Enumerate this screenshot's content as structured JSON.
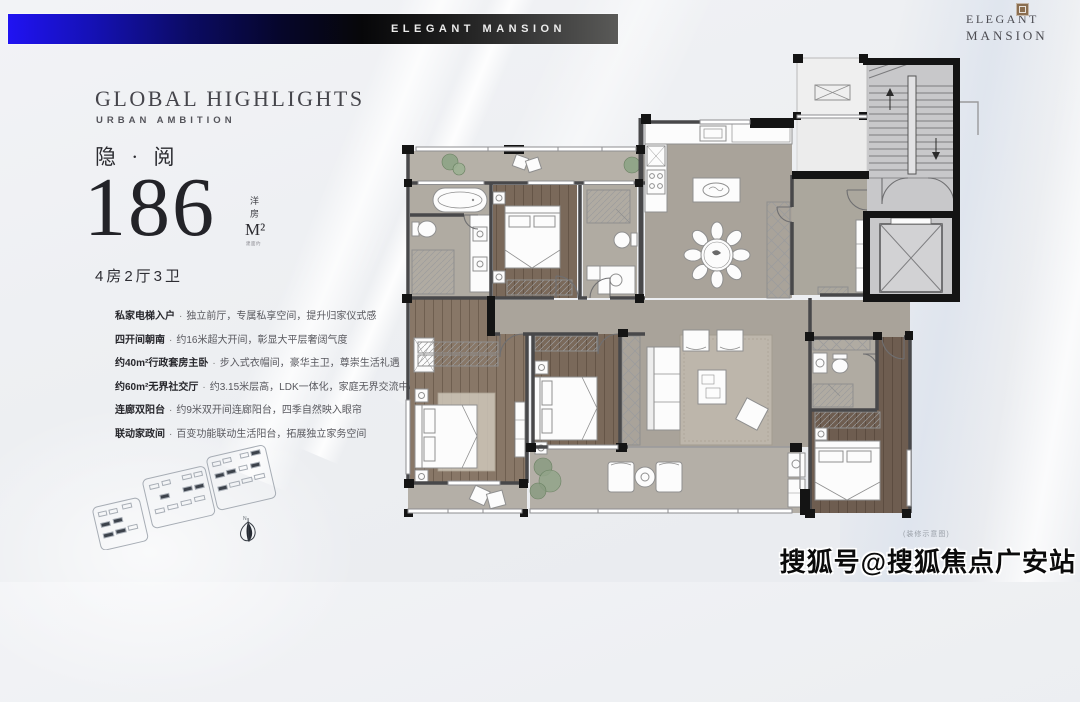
{
  "banner": {
    "title": "ELEGANT MANSION"
  },
  "logo": {
    "line1": "ELEGANT",
    "line2": "MANSION"
  },
  "panel": {
    "title": "GLOBAL HIGHLIGHTS",
    "subtitle": "URBAN AMBITION",
    "name_cn": "隐 · 阅",
    "area_value": "186",
    "area_unit": "M²",
    "area_type": "洋房",
    "area_note": "建面约",
    "layout": "4房2厅3卫",
    "separator": "·",
    "features": [
      {
        "label": "私家电梯入户",
        "desc": "独立前厅，专属私享空间，提升归家仪式感"
      },
      {
        "label": "四开间朝南",
        "desc": "约16米超大开间，彰显大平层奢阔气度"
      },
      {
        "label": "约40m²行政套房主卧",
        "desc": "步入式衣帽间，豪华主卫，尊崇生活礼遇"
      },
      {
        "label": "约60m²无界社交厅",
        "desc": "约3.15米层高，LDK一体化，家庭无界交流中心"
      },
      {
        "label": "连廊双阳台",
        "desc": "约9米双开间连廊阳台，四季自然映入眼帘"
      },
      {
        "label": "联动家政间",
        "desc": "百变功能联动生活阳台，拓展独立家务空间"
      }
    ]
  },
  "diagrams": {
    "compass_label": "N"
  },
  "floorplan": {
    "caption": "(装修示意图)"
  },
  "watermark": {
    "text": "搜狐号@搜狐焦点广安站"
  },
  "colors": {
    "banner_blue": "#2013f2",
    "banner_gray_end": "#5a5a58",
    "seal_bronze": "#8a6e50",
    "wall_dark": "#48484a",
    "wall_black": "#141414",
    "floor_gray": "#a9a39a",
    "wood": "#7a695a",
    "plant_green": "#8ea486"
  }
}
